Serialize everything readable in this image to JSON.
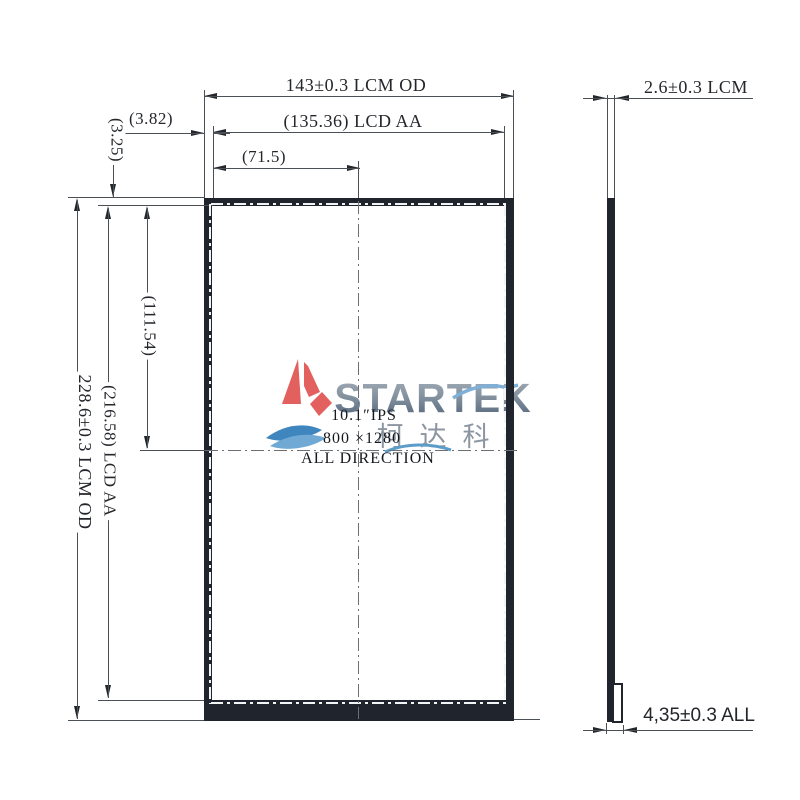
{
  "drawing_title": "LCM outline drawing",
  "dimensions": {
    "top_od": "143±0.3 LCM OD",
    "top_aa": "(135.36) LCD AA",
    "top_half": "(71.5)",
    "left_gap_h": "(3.82)",
    "left_gap_v": "(3.25)",
    "left_half": "(111.54)",
    "left_aa": "(216.58) LCD AA",
    "left_od": "228.6±0.3 LCM OD",
    "side_thickness": "2.6±0.3 LCM",
    "side_total": "4,35±0.3 ALL"
  },
  "panel_text": {
    "line1": "10.1″IPS",
    "line2": "800 ×1280",
    "line3": "ALL DIRECTION"
  },
  "logo": {
    "brand": "STARTEK",
    "chinese": "柯达科",
    "sail_color": "#e2605e",
    "wave_dark": "#3e86bd",
    "wave_light": "#6fa9d4",
    "brand_color": "#77879a"
  },
  "colors": {
    "bezel": "#20242c",
    "line": "#4b5056",
    "background": "#ffffff",
    "aa_dash": "#f2f4f6"
  }
}
